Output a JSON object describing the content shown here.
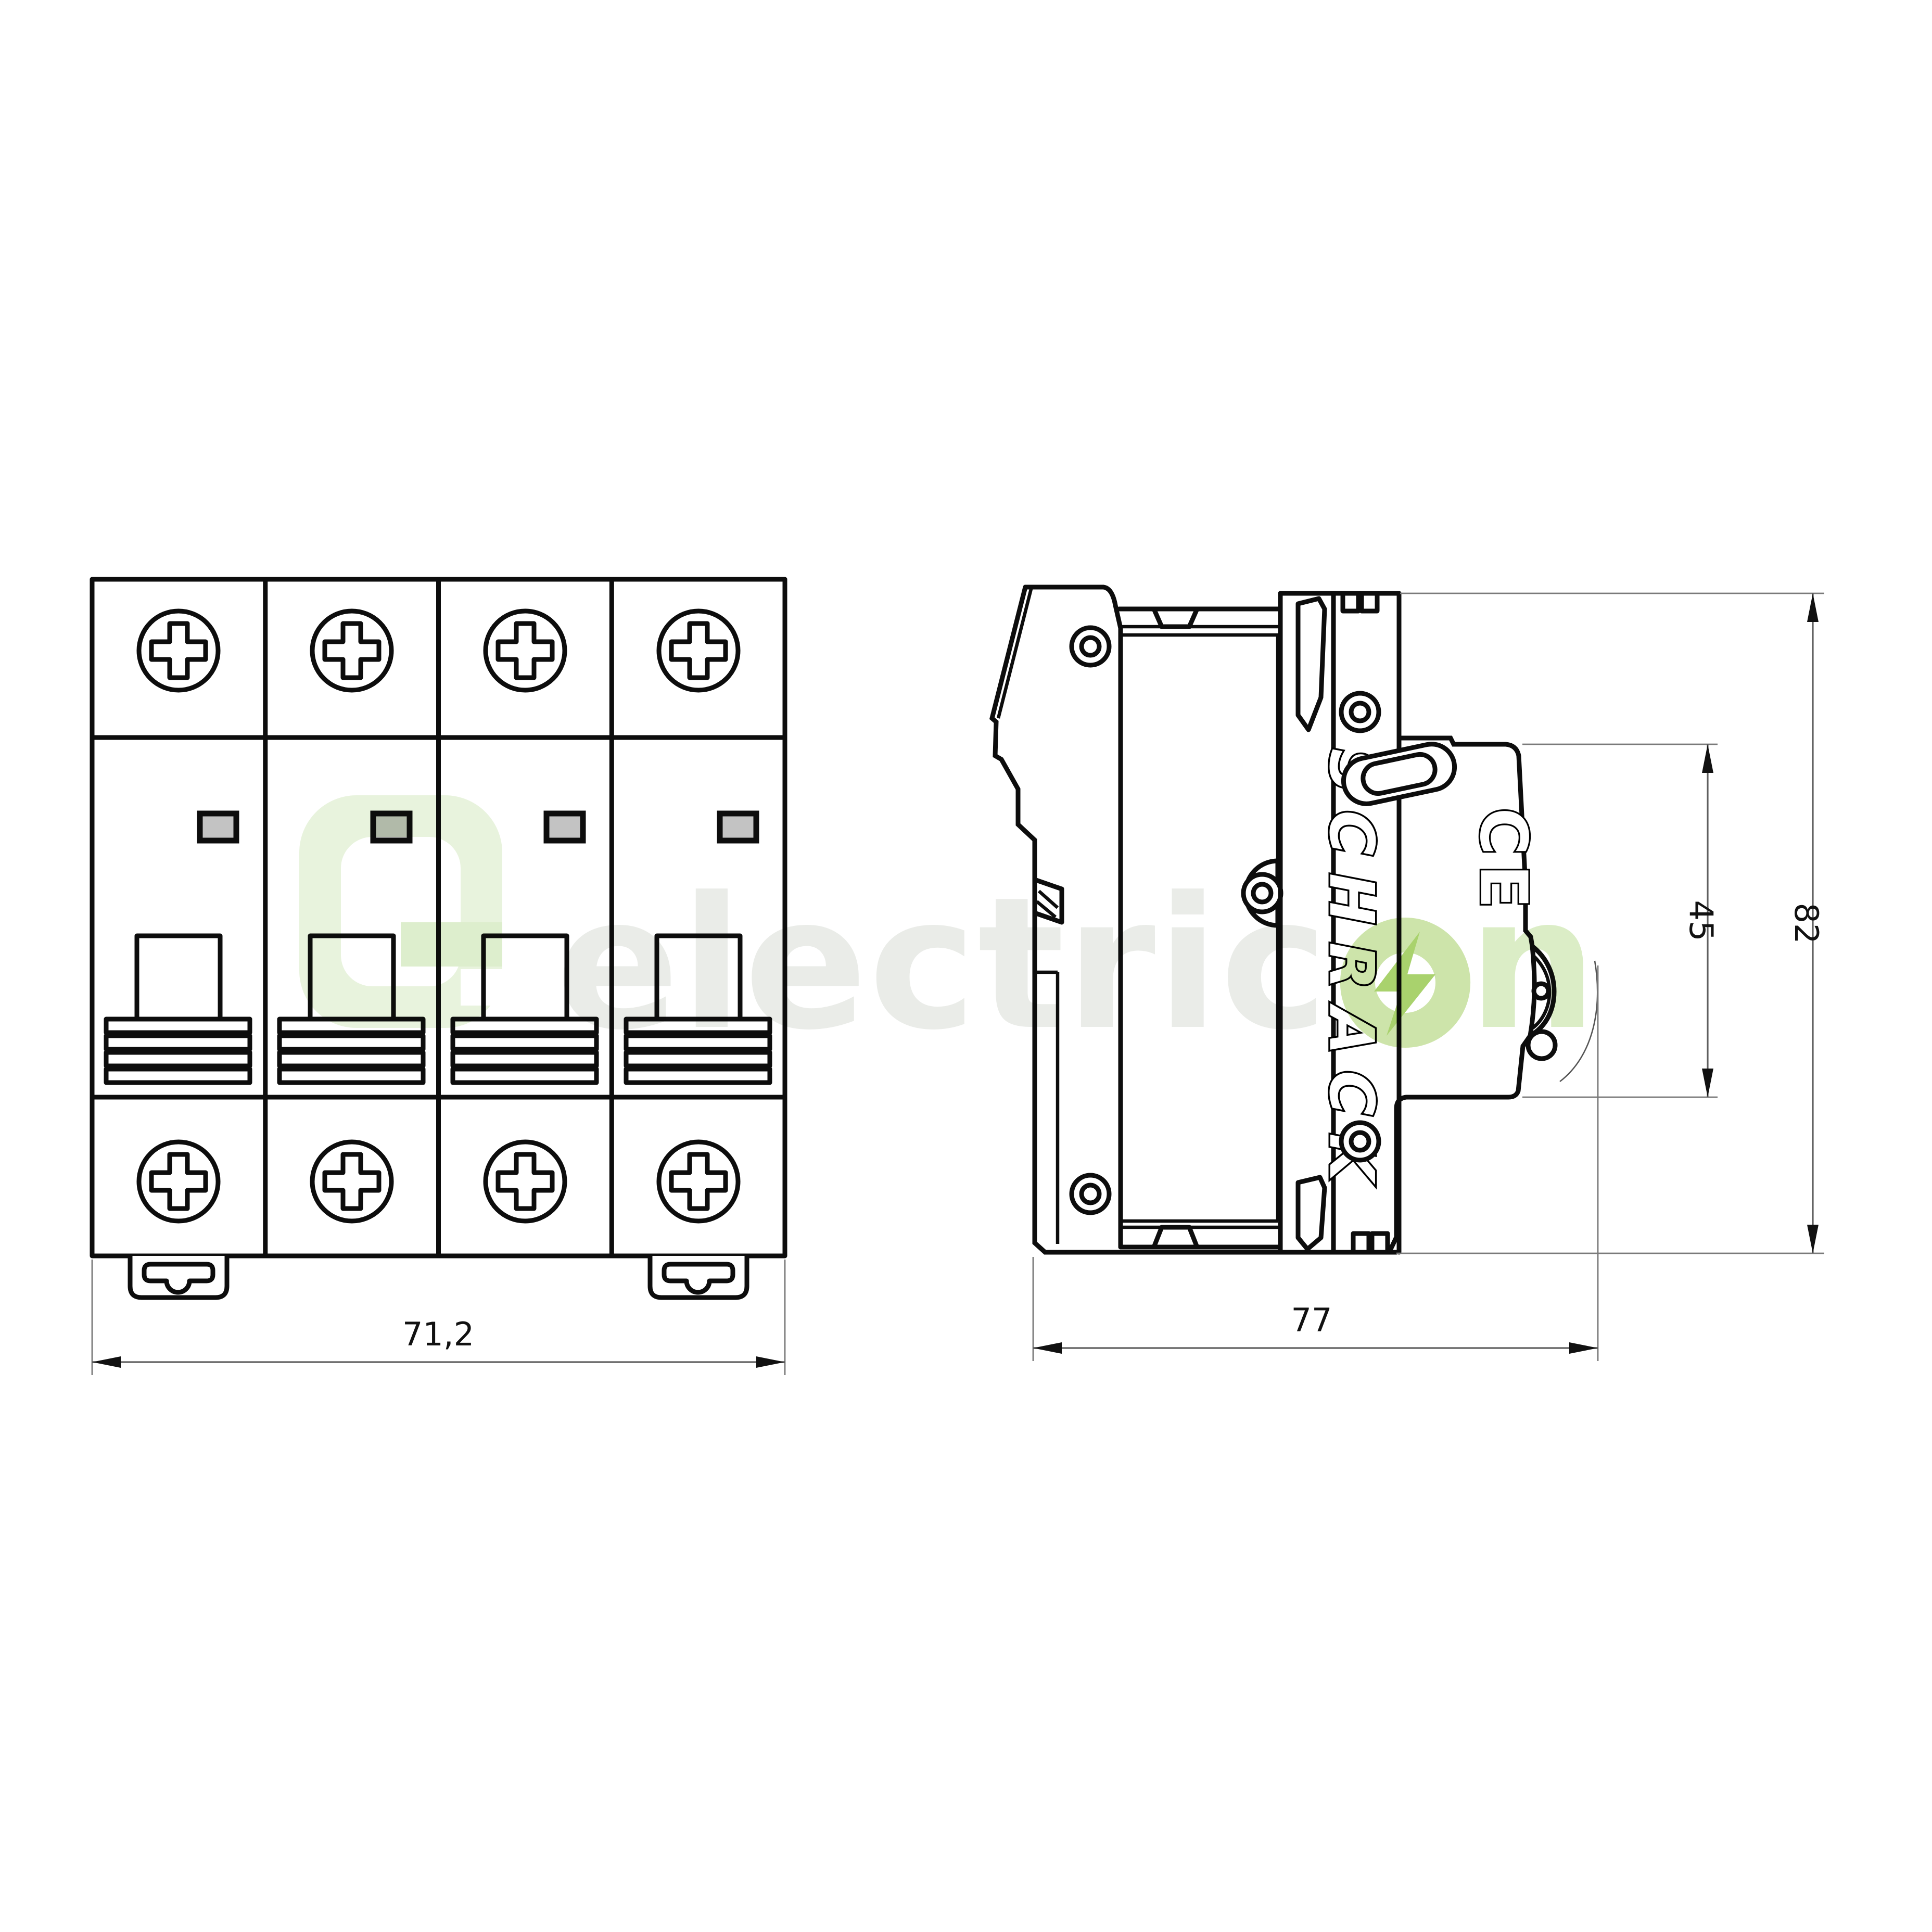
{
  "front_view": {
    "module_count": 4,
    "width_dimension_label": "71,2",
    "indicator_fill": "#c3c3c3"
  },
  "side_view": {
    "brand_text": "SCHRACK",
    "certification_text": "CE",
    "height_dimension_label": "82",
    "front_height_dimension_label": "45",
    "depth_dimension_label": "77"
  },
  "watermark": {
    "word_gray": "electric",
    "word_green_letter": "n",
    "logo_name": "electricon-g-logo",
    "bolt_icon": "lightning-bolt-icon",
    "colors": {
      "gray_text": "#e9ebe7",
      "logo_ring": "#e7f3db",
      "logo_bar": "#dcedcb",
      "o_ring": "#cbe3a6",
      "bolt": "#a5d065",
      "n_text": "#d9ecc3"
    }
  },
  "drawing": {
    "line_color": "#0d0d0d",
    "dim_line_color": "#5f5f5f"
  }
}
